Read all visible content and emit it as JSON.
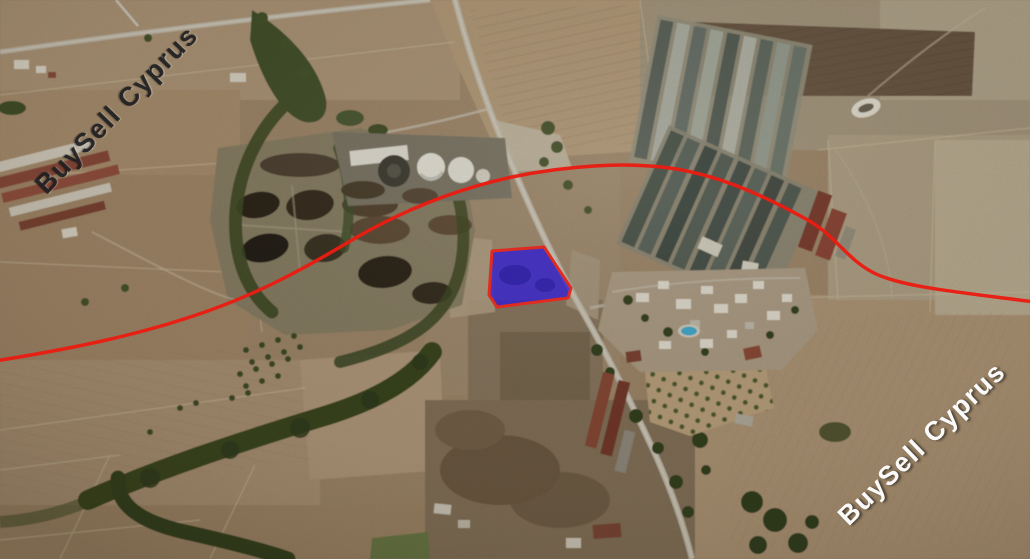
{
  "image": {
    "kind": "satellite-aerial-photo"
  },
  "watermarks": [
    {
      "text": "BuySell Cyprus",
      "corner": "top-left",
      "color": "#1a1a1c"
    },
    {
      "text": "BuySell Cyprus",
      "corner": "bottom-right",
      "color": "#ffffff"
    }
  ],
  "annotations": {
    "plot": {
      "fill": "rgba(41,24,214,0.75)",
      "stroke": "#df2b20",
      "stroke_width": "3"
    },
    "route": {
      "stroke": "#ea1c12",
      "stroke_width": "3.5"
    }
  }
}
